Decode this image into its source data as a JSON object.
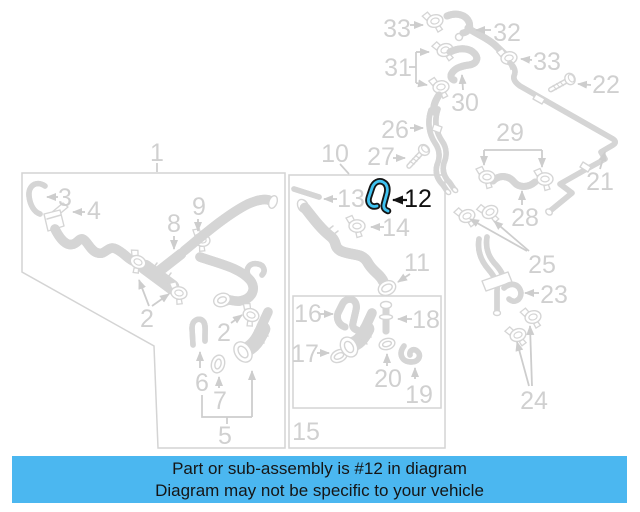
{
  "page": {
    "width": 640,
    "height": 512,
    "background": "#ffffff"
  },
  "diagram": {
    "type": "parts-diagram",
    "line_color": "#d5d5d5",
    "label_color": "#d0d0d0",
    "label_font_size": 25,
    "highlighted_part": {
      "number": "12",
      "outline_color": "#141414",
      "highlight_color": "#3fc2f0",
      "label_color": "#111111"
    },
    "labels": [
      {
        "name": "1",
        "text": "1",
        "x": 157,
        "y": 161
      },
      {
        "name": "3",
        "text": "3",
        "x": 65,
        "y": 206
      },
      {
        "name": "4",
        "text": "4",
        "x": 94,
        "y": 219
      },
      {
        "name": "8",
        "text": "8",
        "x": 174,
        "y": 232
      },
      {
        "name": "9",
        "text": "9",
        "x": 199,
        "y": 215
      },
      {
        "name": "2a",
        "text": "2",
        "x": 147,
        "y": 327
      },
      {
        "name": "2b",
        "text": "2",
        "x": 224,
        "y": 341
      },
      {
        "name": "6",
        "text": "6",
        "x": 202,
        "y": 391
      },
      {
        "name": "7",
        "text": "7",
        "x": 220,
        "y": 409
      },
      {
        "name": "5",
        "text": "5",
        "x": 225,
        "y": 444
      },
      {
        "name": "10",
        "text": "10",
        "x": 335,
        "y": 162
      },
      {
        "name": "13",
        "text": "13",
        "x": 351,
        "y": 207
      },
      {
        "name": "12",
        "text": "12",
        "x": 418,
        "y": 207,
        "highlighted": true
      },
      {
        "name": "14",
        "text": "14",
        "x": 396,
        "y": 236
      },
      {
        "name": "11",
        "text": "11",
        "x": 417,
        "y": 271
      },
      {
        "name": "16",
        "text": "16",
        "x": 308,
        "y": 322
      },
      {
        "name": "17",
        "text": "17",
        "x": 305,
        "y": 362
      },
      {
        "name": "18",
        "text": "18",
        "x": 426,
        "y": 328
      },
      {
        "name": "20",
        "text": "20",
        "x": 388,
        "y": 387
      },
      {
        "name": "19",
        "text": "19",
        "x": 419,
        "y": 403
      },
      {
        "name": "15",
        "text": "15",
        "x": 306,
        "y": 440
      },
      {
        "name": "33a",
        "text": "33",
        "x": 397,
        "y": 37
      },
      {
        "name": "32",
        "text": "32",
        "x": 507,
        "y": 41
      },
      {
        "name": "31",
        "text": "31",
        "x": 398,
        "y": 76
      },
      {
        "name": "33b",
        "text": "33",
        "x": 547,
        "y": 70
      },
      {
        "name": "22",
        "text": "22",
        "x": 606,
        "y": 93
      },
      {
        "name": "30",
        "text": "30",
        "x": 465,
        "y": 111
      },
      {
        "name": "26",
        "text": "26",
        "x": 395,
        "y": 138
      },
      {
        "name": "27",
        "text": "27",
        "x": 381,
        "y": 165
      },
      {
        "name": "29",
        "text": "29",
        "x": 510,
        "y": 141
      },
      {
        "name": "21",
        "text": "21",
        "x": 600,
        "y": 190
      },
      {
        "name": "28",
        "text": "28",
        "x": 525,
        "y": 226
      },
      {
        "name": "25",
        "text": "25",
        "x": 542,
        "y": 273
      },
      {
        "name": "23",
        "text": "23",
        "x": 554,
        "y": 303
      },
      {
        "name": "24",
        "text": "24",
        "x": 534,
        "y": 409
      }
    ]
  },
  "caption": {
    "line1": "Part or sub-assembly is #12 in diagram",
    "line2": "Diagram may not be specific to your vehicle",
    "background": "#4bb7f0",
    "text_color": "#151515"
  }
}
